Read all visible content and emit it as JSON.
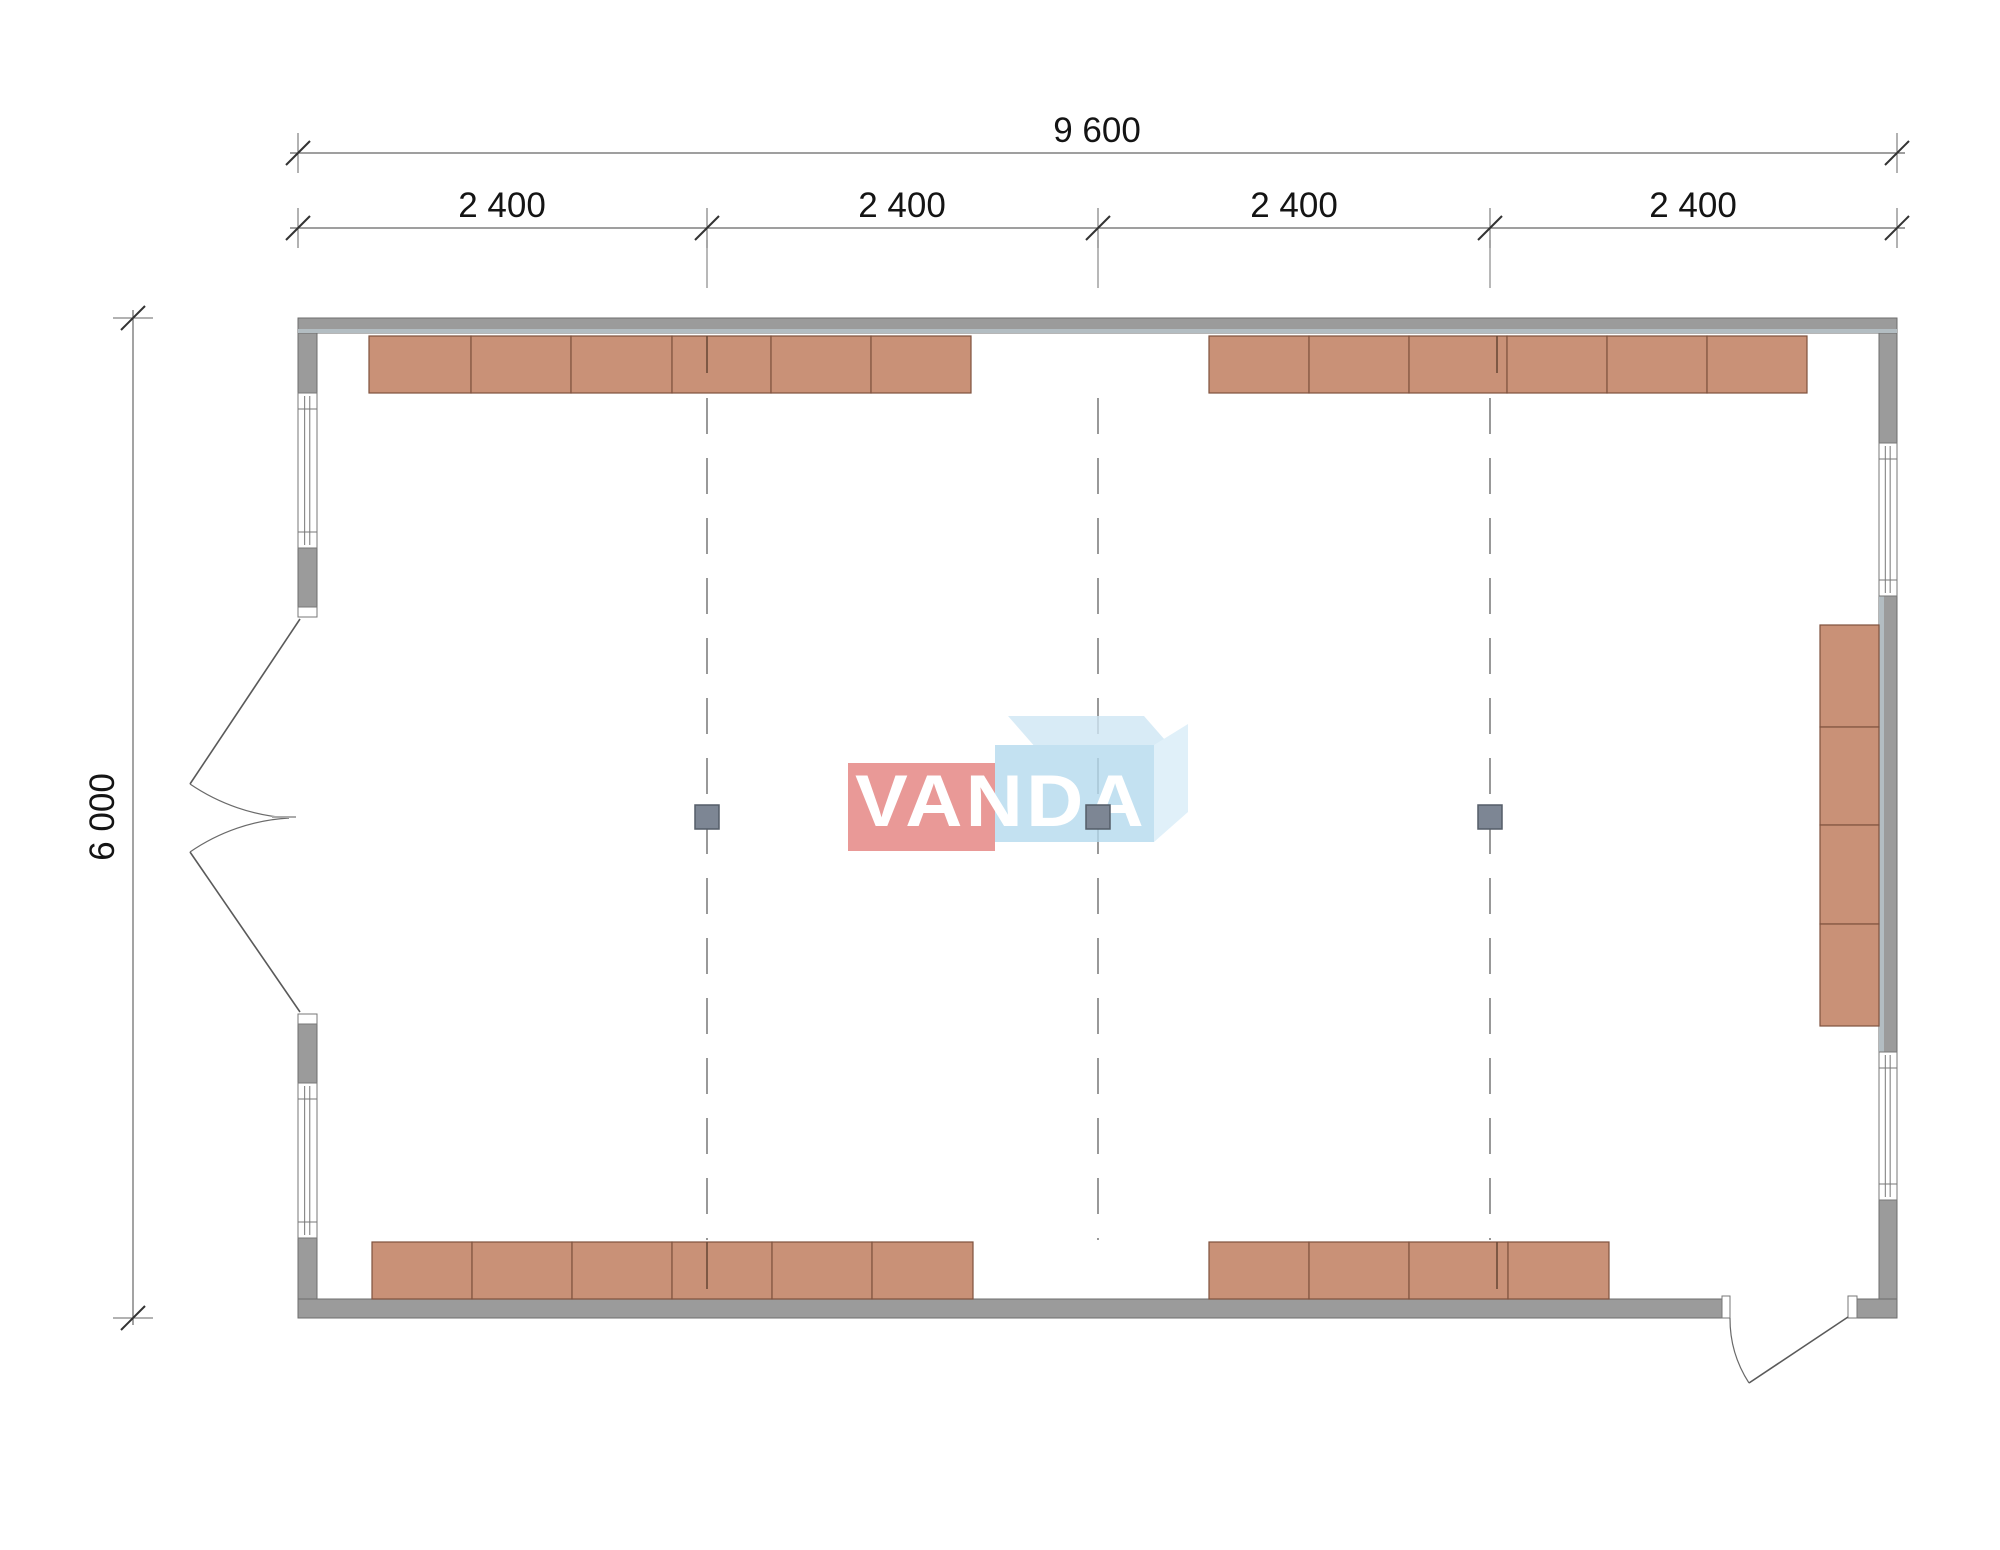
{
  "page": {
    "background": "#ffffff"
  },
  "colors": {
    "wall": "#9b9b9b",
    "wall_stroke": "#6e6e6e",
    "wall_stripe": "#b3bdc2",
    "furniture": "#c99177",
    "furniture_stroke": "#7e523e",
    "column": "#7d8694",
    "column_stroke": "#555d68",
    "window_stroke": "#777777",
    "grid": "#555555",
    "door": "#5a5a5a",
    "dim_line": "#666666",
    "dim_tick": "#333333",
    "dim_text": "#141414"
  },
  "dimensions": {
    "total_width_label": "9 600",
    "bays": [
      {
        "label": "2 400"
      },
      {
        "label": "2 400"
      },
      {
        "label": "2 400"
      },
      {
        "label": "2 400"
      }
    ],
    "height_label": "6 000"
  },
  "watermark": {
    "text": "VANDA",
    "red": "#e4807e",
    "blue": "#b5daee",
    "pale_top": "#cfe7f5",
    "pale_right": "#d9edf8"
  },
  "plan": {
    "walls": [
      {
        "x": 298,
        "y": 318,
        "w": 1599,
        "h": 15
      },
      {
        "x": 298,
        "y": 1299,
        "w": 1424,
        "h": 19
      },
      {
        "x": 1857,
        "y": 1299,
        "w": 40,
        "h": 19
      },
      {
        "x": 298,
        "y": 333,
        "w": 19,
        "h": 60
      },
      {
        "x": 298,
        "y": 548,
        "w": 19,
        "h": 59
      },
      {
        "x": 298,
        "y": 1024,
        "w": 19,
        "h": 59
      },
      {
        "x": 298,
        "y": 1238,
        "w": 19,
        "h": 61
      },
      {
        "x": 1879,
        "y": 333,
        "w": 18,
        "h": 110
      },
      {
        "x": 1879,
        "y": 596,
        "w": 18,
        "h": 456
      },
      {
        "x": 1879,
        "y": 1200,
        "w": 18,
        "h": 99
      }
    ],
    "stripes": [
      {
        "x": 298,
        "y": 329,
        "w": 1599,
        "h": 4
      },
      {
        "x": 1879,
        "y": 596,
        "w": 5,
        "h": 456
      }
    ],
    "jambs": [
      {
        "x": 298,
        "y": 607,
        "w": 19,
        "h": 10
      },
      {
        "x": 298,
        "y": 1014,
        "w": 19,
        "h": 10
      },
      {
        "x": 1722,
        "y": 1296,
        "w": 8,
        "h": 22
      },
      {
        "x": 1848,
        "y": 1296,
        "w": 9,
        "h": 22
      }
    ],
    "windows": [
      {
        "x": 298,
        "y": 393,
        "w": 19,
        "h": 155
      },
      {
        "x": 298,
        "y": 1083,
        "w": 19,
        "h": 155
      },
      {
        "x": 1879,
        "y": 443,
        "w": 18,
        "h": 153
      },
      {
        "x": 1879,
        "y": 1052,
        "w": 18,
        "h": 148
      }
    ],
    "furniture": [
      {
        "x": 369,
        "y": 336,
        "w": 102,
        "h": 57
      },
      {
        "x": 471,
        "y": 336,
        "w": 100,
        "h": 57
      },
      {
        "x": 571,
        "y": 336,
        "w": 101,
        "h": 57
      },
      {
        "x": 672,
        "y": 336,
        "w": 99,
        "h": 57
      },
      {
        "x": 771,
        "y": 336,
        "w": 100,
        "h": 57
      },
      {
        "x": 871,
        "y": 336,
        "w": 100,
        "h": 57
      },
      {
        "x": 1209,
        "y": 336,
        "w": 100,
        "h": 57
      },
      {
        "x": 1309,
        "y": 336,
        "w": 100,
        "h": 57
      },
      {
        "x": 1409,
        "y": 336,
        "w": 98,
        "h": 57
      },
      {
        "x": 1507,
        "y": 336,
        "w": 100,
        "h": 57
      },
      {
        "x": 1607,
        "y": 336,
        "w": 100,
        "h": 57
      },
      {
        "x": 1707,
        "y": 336,
        "w": 100,
        "h": 57
      },
      {
        "x": 372,
        "y": 1242,
        "w": 100,
        "h": 57
      },
      {
        "x": 472,
        "y": 1242,
        "w": 100,
        "h": 57
      },
      {
        "x": 572,
        "y": 1242,
        "w": 100,
        "h": 57
      },
      {
        "x": 672,
        "y": 1242,
        "w": 100,
        "h": 57
      },
      {
        "x": 772,
        "y": 1242,
        "w": 100,
        "h": 57
      },
      {
        "x": 872,
        "y": 1242,
        "w": 101,
        "h": 57
      },
      {
        "x": 1209,
        "y": 1242,
        "w": 100,
        "h": 57
      },
      {
        "x": 1309,
        "y": 1242,
        "w": 100,
        "h": 57
      },
      {
        "x": 1409,
        "y": 1242,
        "w": 99,
        "h": 57
      },
      {
        "x": 1508,
        "y": 1242,
        "w": 101,
        "h": 57
      },
      {
        "x": 1820,
        "y": 625,
        "w": 59,
        "h": 102
      },
      {
        "x": 1820,
        "y": 727,
        "w": 59,
        "h": 98
      },
      {
        "x": 1820,
        "y": 825,
        "w": 59,
        "h": 99
      },
      {
        "x": 1820,
        "y": 924,
        "w": 59,
        "h": 102
      }
    ],
    "columns": [
      {
        "cx": 707,
        "cy": 817,
        "s": 24
      },
      {
        "cx": 1098,
        "cy": 817,
        "s": 24
      },
      {
        "cx": 1490,
        "cy": 817,
        "s": 24
      }
    ],
    "grid_lines": [
      {
        "x": 707,
        "y1": 398,
        "y2": 1240
      },
      {
        "x": 1098,
        "y1": 398,
        "y2": 1240
      },
      {
        "x": 1490,
        "y1": 398,
        "y2": 1240
      }
    ],
    "grid_stubs": [
      {
        "x": 707,
        "y1": 240,
        "y2": 288
      },
      {
        "x": 1098,
        "y1": 240,
        "y2": 288
      },
      {
        "x": 1490,
        "y1": 240,
        "y2": 288
      }
    ],
    "slits": [
      {
        "x": 707,
        "y1": 336,
        "y2": 373
      },
      {
        "x": 1497,
        "y1": 336,
        "y2": 373
      },
      {
        "x": 707,
        "y1": 1242,
        "y2": 1289
      },
      {
        "x": 1497,
        "y1": 1242,
        "y2": 1289
      }
    ],
    "doors": [
      {
        "leaf": [
          300,
          619,
          190,
          784
        ],
        "arc": "M 190 784 A 198 198 0 0 0 289 818"
      },
      {
        "leaf": [
          300,
          1012,
          190,
          852
        ],
        "arc": "M 190 852 A 194 194 0 0 1 289 818"
      },
      {
        "leaf": [
          1848,
          1317,
          1749,
          1383
        ],
        "arc": "M 1730 1318 A 118 118 0 0 0 1749 1383"
      }
    ],
    "door_apex": {
      "x1": 272,
      "y1": 817,
      "x2": 296,
      "y2": 817
    },
    "dim_lines": [
      {
        "x1": 290,
        "y1": 153,
        "x2": 1905,
        "y2": 153
      },
      {
        "x1": 290,
        "y1": 228,
        "x2": 1905,
        "y2": 228
      },
      {
        "x1": 133,
        "y1": 310,
        "x2": 133,
        "y2": 1325
      }
    ],
    "dim_ticks_v": [
      {
        "x": 298,
        "y": 153
      },
      {
        "x": 1897,
        "y": 153
      },
      {
        "x": 298,
        "y": 228
      },
      {
        "x": 707,
        "y": 228
      },
      {
        "x": 1098,
        "y": 228
      },
      {
        "x": 1490,
        "y": 228
      },
      {
        "x": 1897,
        "y": 228
      }
    ],
    "dim_ticks_h": [
      {
        "x": 133,
        "y": 318
      },
      {
        "x": 133,
        "y": 1318
      }
    ]
  }
}
